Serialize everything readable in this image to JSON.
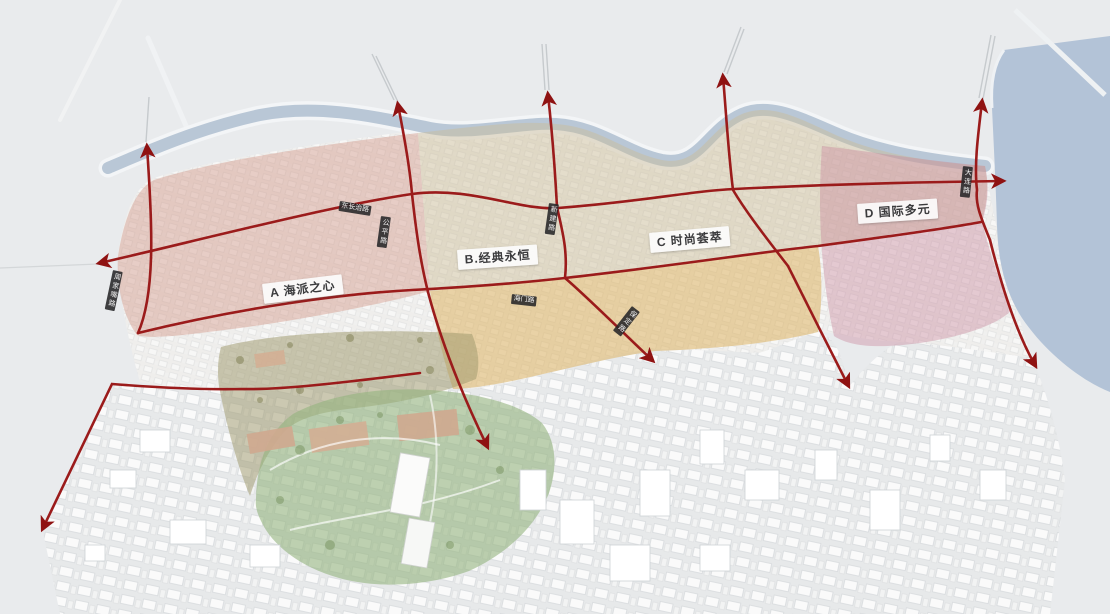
{
  "map": {
    "description": "Aerial urban planning rendering of a riverside district divided into four themed zones with red circulation arrows",
    "zones": [
      {
        "id": "A",
        "label": "A 海派之心",
        "color": "#d29384"
      },
      {
        "id": "B",
        "label": "B.经典永恒",
        "color": "#dcae55"
      },
      {
        "id": "C",
        "label": "C 时尚荟萃",
        "color": "#cdbd96"
      },
      {
        "id": "D",
        "label": "D 国际多元",
        "color": "#c9849b"
      }
    ],
    "road_labels": [
      {
        "text": "东长治路"
      },
      {
        "text": "周家嘴路"
      },
      {
        "text": "公平路"
      },
      {
        "text": "海门路"
      },
      {
        "text": "新建路"
      },
      {
        "text": "保定路"
      },
      {
        "text": "大连路"
      }
    ],
    "colors": {
      "road": "#9b1b1b",
      "arrow": "#8f1212",
      "water": "#b3c3d7",
      "river": "#b9c7d6",
      "land": "#e9ebed",
      "park_green": "#94b47e",
      "grove_olive": "#9f9a6d",
      "zone_label_bg": "#fcfcfc",
      "road_chip_bg": "#262628"
    }
  }
}
